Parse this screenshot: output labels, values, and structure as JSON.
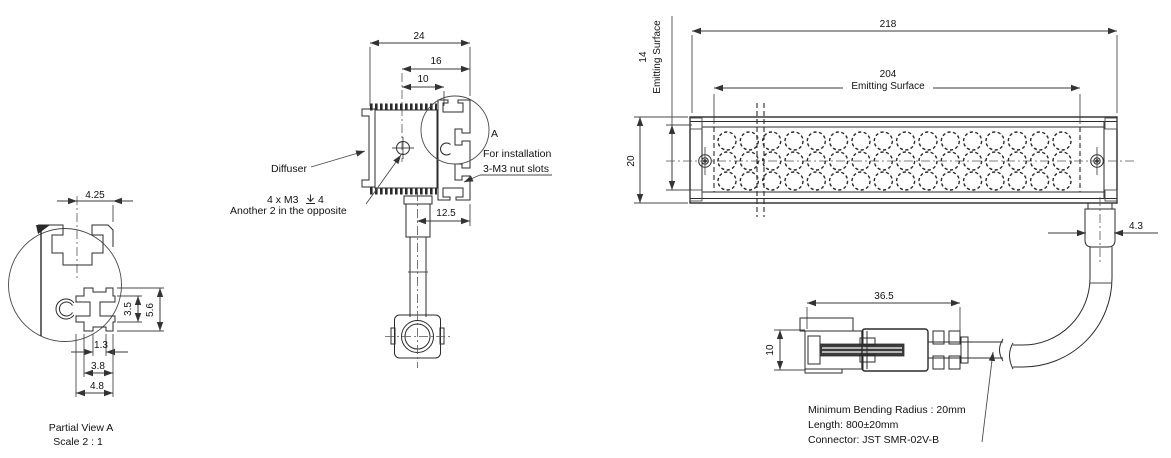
{
  "views": {
    "partial_view_a": {
      "dim_width_top": "4.25",
      "dim_slot_inner_height": "3.5",
      "dim_slot_outer_height": "5.6",
      "dim_mouth_width": "1.3",
      "dim_mid_width": "3.8",
      "dim_outer_width": "4.8",
      "caption_line1": "Partial View A",
      "caption_line2": "Scale 2 : 1"
    },
    "end_view": {
      "dim_overall_width": "24",
      "dim_slot_span": "16",
      "dim_hole_offset": "10",
      "dim_cable_offset": "12.5",
      "label_diffuser": "Diffuser",
      "label_thread_prefix": "4 x M3",
      "label_thread_depth": "4",
      "label_thread_line2": "Another 2 in the opposite",
      "label_detail": "A",
      "label_install_line1": "For installation",
      "label_install_line2": "3-M3 nut slots"
    },
    "front_view": {
      "dim_overall_length": "218",
      "dim_emitting_length": "204",
      "label_emitting_h": "Emitting Surface",
      "dim_emitting_height": "14",
      "label_emitting_v": "Emitting Surface",
      "dim_overall_height": "20",
      "dim_cable_width": "4.3",
      "led_grid": {
        "rows": 3,
        "cols": 16
      }
    },
    "cable_view": {
      "dim_connector_length": "36.5",
      "dim_connector_height": "10",
      "note_line1": "Minimum Bending Radius : 20mm",
      "note_line2": "Length: 800±20mm",
      "note_line3": "Connector: JST SMR-02V-B"
    }
  },
  "colors": {
    "line": "#2b2b2b",
    "thin_line": "#4a4a4a",
    "text": "#111111",
    "background": "#ffffff"
  }
}
